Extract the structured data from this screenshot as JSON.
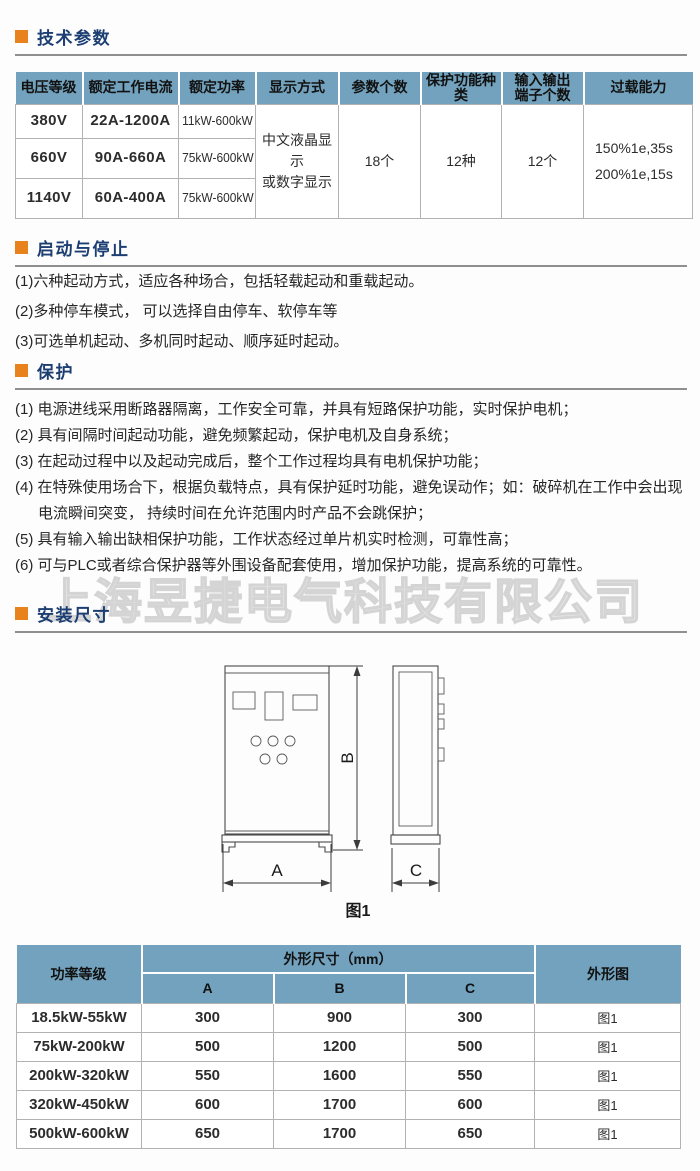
{
  "colors": {
    "table_header_bg": "#72a2bd",
    "accent_orange": "#e8821d",
    "heading_blue": "#1c3e73"
  },
  "watermark": "上海昱捷电气科技有限公司",
  "sections": {
    "tech": {
      "title": "技术参数"
    },
    "start_stop": {
      "title": "启动与停止",
      "items": [
        "(1)六种起动方式，适应各种场合，包括轻载起动和重载起动。",
        "(2)多种停车模式， 可以选择自由停车、软停车等",
        "(3)可选单机起动、多机同时起动、顺序延时起动。"
      ]
    },
    "protection": {
      "title": "保护",
      "items": [
        "(1) 电源进线采用断路器隔离，工作安全可靠，并具有短路保护功能，实时保护电机；",
        "(2) 具有间隔时间起动功能，避免频繁起动，保护电机及自身系统；",
        "(3) 在起动过程中以及起动完成后，整个工作过程均具有电机保护功能；",
        "(4) 在特殊使用场合下，根据负载特点，具有保护延时功能，避免误动作；如：破碎机在工作中会出现电流瞬间突变， 持续时间在允许范围内时产品不会跳保护；",
        "(5) 具有输入输出缺相保护功能，工作状态经过单片机实时检测，可靠性高；",
        "(6) 可与PLC或者综合保护器等外围设备配套使用，增加保护功能，提高系统的可靠性。"
      ]
    },
    "install": {
      "title": "安装尺寸"
    }
  },
  "spec_table": {
    "headers": [
      "电压等级",
      "额定工作电流",
      "额定功率",
      "显示方式",
      "参数个数",
      "保护功能种类",
      [
        "输入输出",
        "端子个数"
      ],
      "过载能力"
    ],
    "rows": [
      [
        "380V",
        "22A-1200A",
        "11kW-600kW"
      ],
      [
        "660V",
        "90A-660A",
        "75kW-600kW"
      ],
      [
        "1140V",
        "60A-400A",
        "75kW-600kW"
      ]
    ],
    "display_mode_lines": [
      "中文液晶显示",
      "或数字显示"
    ],
    "param_count": "18个",
    "protection_kinds": "12种",
    "io_terminal_count": "12个",
    "overload_lines": [
      "150%1e,35s",
      "200%1e,15s"
    ]
  },
  "figure": {
    "caption": "图1",
    "dim_a": "A",
    "dim_b": "B",
    "dim_c": "C"
  },
  "dimension_table": {
    "power_header": "功率等级",
    "dims_header": "外形尺寸（mm）",
    "dim_cols": [
      "A",
      "B",
      "C"
    ],
    "outline_header": "外形图",
    "rows": [
      [
        "18.5kW-55kW",
        "300",
        "900",
        "300",
        "图1"
      ],
      [
        "75kW-200kW",
        "500",
        "1200",
        "500",
        "图1"
      ],
      [
        "200kW-320kW",
        "550",
        "1600",
        "550",
        "图1"
      ],
      [
        "320kW-450kW",
        "600",
        "1700",
        "600",
        "图1"
      ],
      [
        "500kW-600kW",
        "650",
        "1700",
        "650",
        "图1"
      ]
    ]
  }
}
